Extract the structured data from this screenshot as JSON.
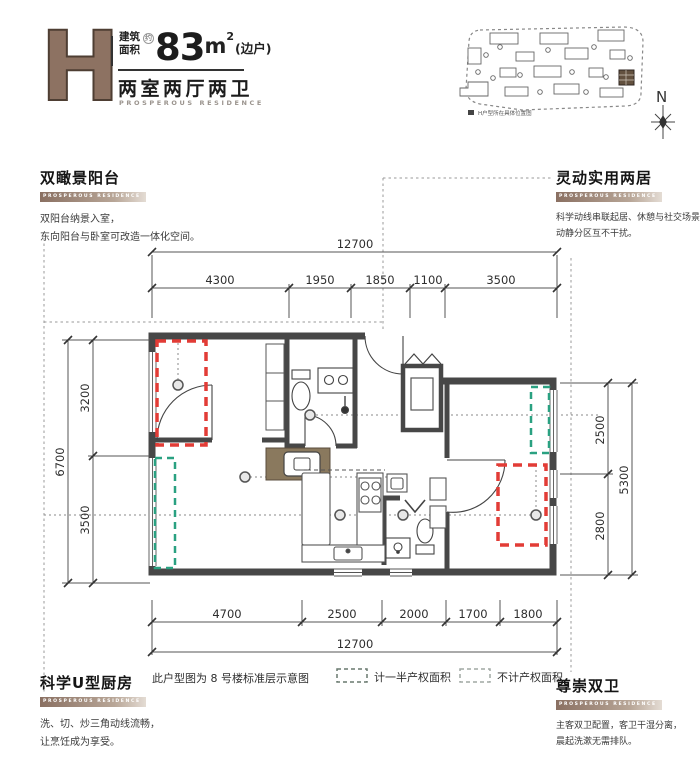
{
  "logo": {
    "letter": "H",
    "area_label_1": "建筑",
    "area_label_2": "面积",
    "approx": "约",
    "area_value": "83",
    "area_unit": "m",
    "area_sup": "2",
    "area_suffix": "(边户)",
    "type_title": "两室两厅两卫",
    "type_subtitle": "PROSPEROUS RESIDENCE"
  },
  "site_plan": {
    "caption": "H户型所在具体位置图",
    "north_label": "N"
  },
  "sections": {
    "top_left": {
      "title": "双瞰景阳台",
      "tag": "PROSPEROUS RESIDENCE",
      "body_1": "双阳台纳景入室，",
      "body_2": "东向阳台与卧室可改造一体化空间。"
    },
    "top_right": {
      "title": "灵动实用两居",
      "tag": "PROSPEROUS RESIDENCE",
      "body_1": "科学动线串联起居、休憩与社交场景，",
      "body_2": "动静分区互不干扰。"
    },
    "bottom_left": {
      "title": "科学U型厨房",
      "tag": "PROSPEROUS RESIDENCE",
      "body_1": "洗、切、炒三角动线流畅，",
      "body_2": "让烹饪成为享受。"
    },
    "bottom_right": {
      "title": "尊崇双卫",
      "tag": "PROSPEROUS RESIDENCE",
      "body_1": "主客双卫配置，客卫干湿分离，",
      "body_2": "晨起洗漱无需排队。"
    }
  },
  "plan": {
    "note": "此户型图为 8 号楼标准层示意图",
    "legend": {
      "half_label": "计一半产权面积",
      "none_label": "不计产权面积"
    },
    "dims": {
      "top_total": "12700",
      "top": [
        "4300",
        "1950",
        "1850",
        "1100",
        "3500"
      ],
      "bottom": [
        "4700",
        "2500",
        "2000",
        "1700",
        "1800"
      ],
      "bottom_total": "12700",
      "left_total": "6700",
      "left": [
        "3200",
        "3500"
      ],
      "right_total": "5300",
      "right": [
        "2500",
        "2800"
      ]
    }
  },
  "colors": {
    "accent_brown": "#8a7062",
    "wall": "#474747",
    "red_dashed": "#e23c36",
    "green_dashed": "#2aa181",
    "wet_area_brown": "#8a795e"
  }
}
